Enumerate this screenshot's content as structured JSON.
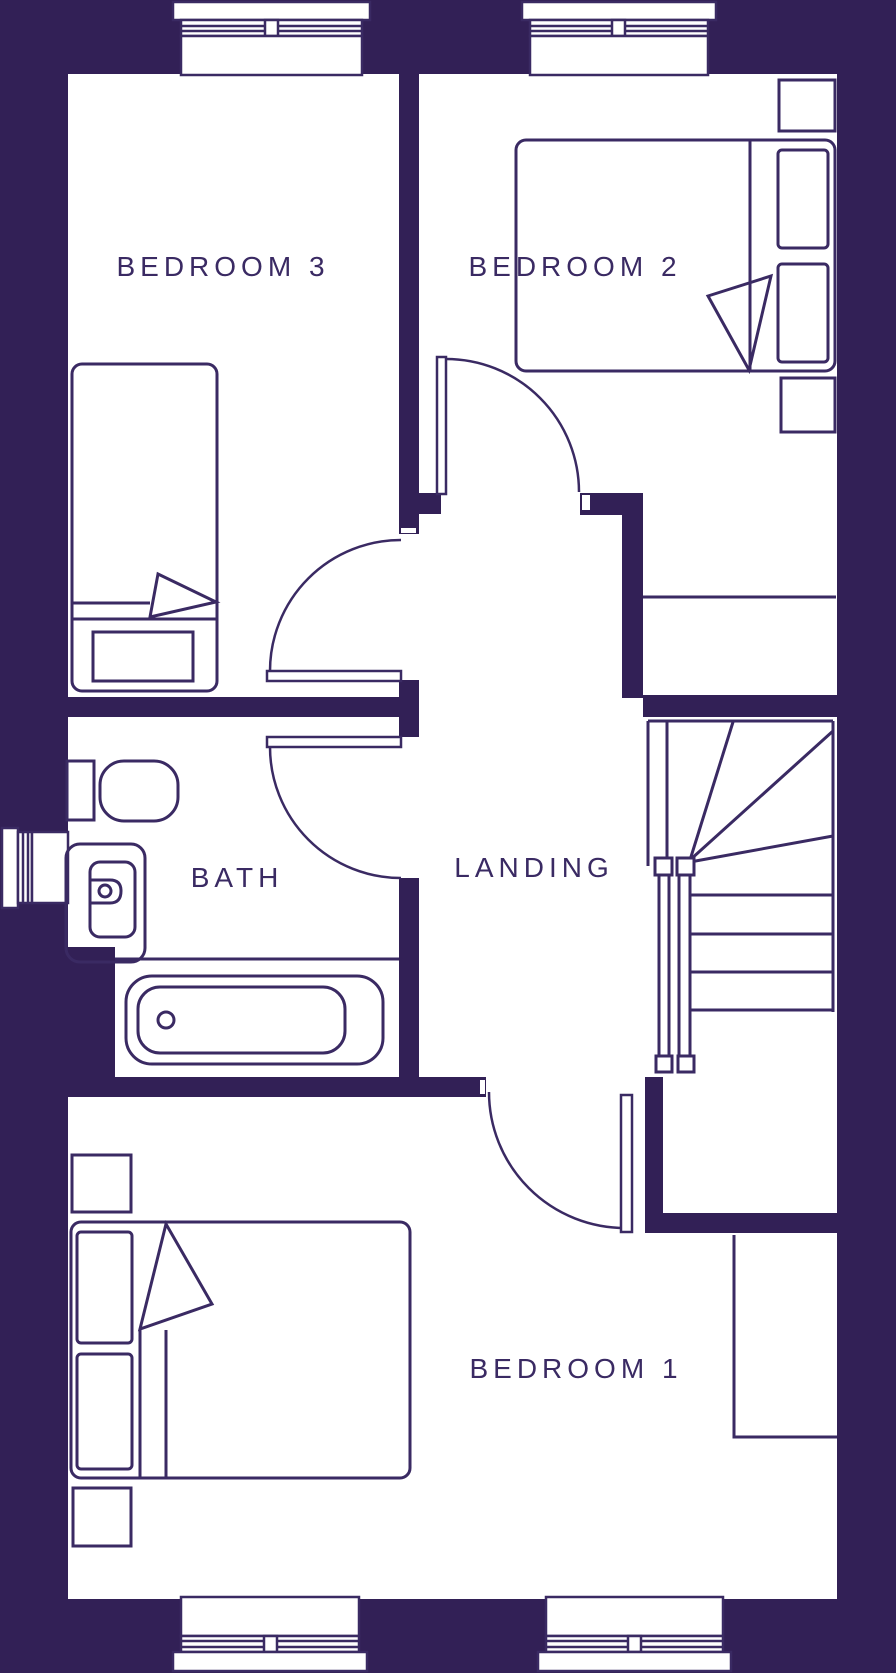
{
  "plan": {
    "floor_name": "first-floor-plan",
    "rooms": {
      "bedroom3": {
        "label": "BEDROOM 3"
      },
      "bedroom2": {
        "label": "BEDROOM 2"
      },
      "bath": {
        "label": "BATH"
      },
      "landing": {
        "label": "LANDING"
      },
      "bedroom1": {
        "label": "BEDROOM 1"
      }
    },
    "colors": {
      "wall": "#322056",
      "ink": "#3a2a63",
      "background": "#ffffff"
    }
  }
}
